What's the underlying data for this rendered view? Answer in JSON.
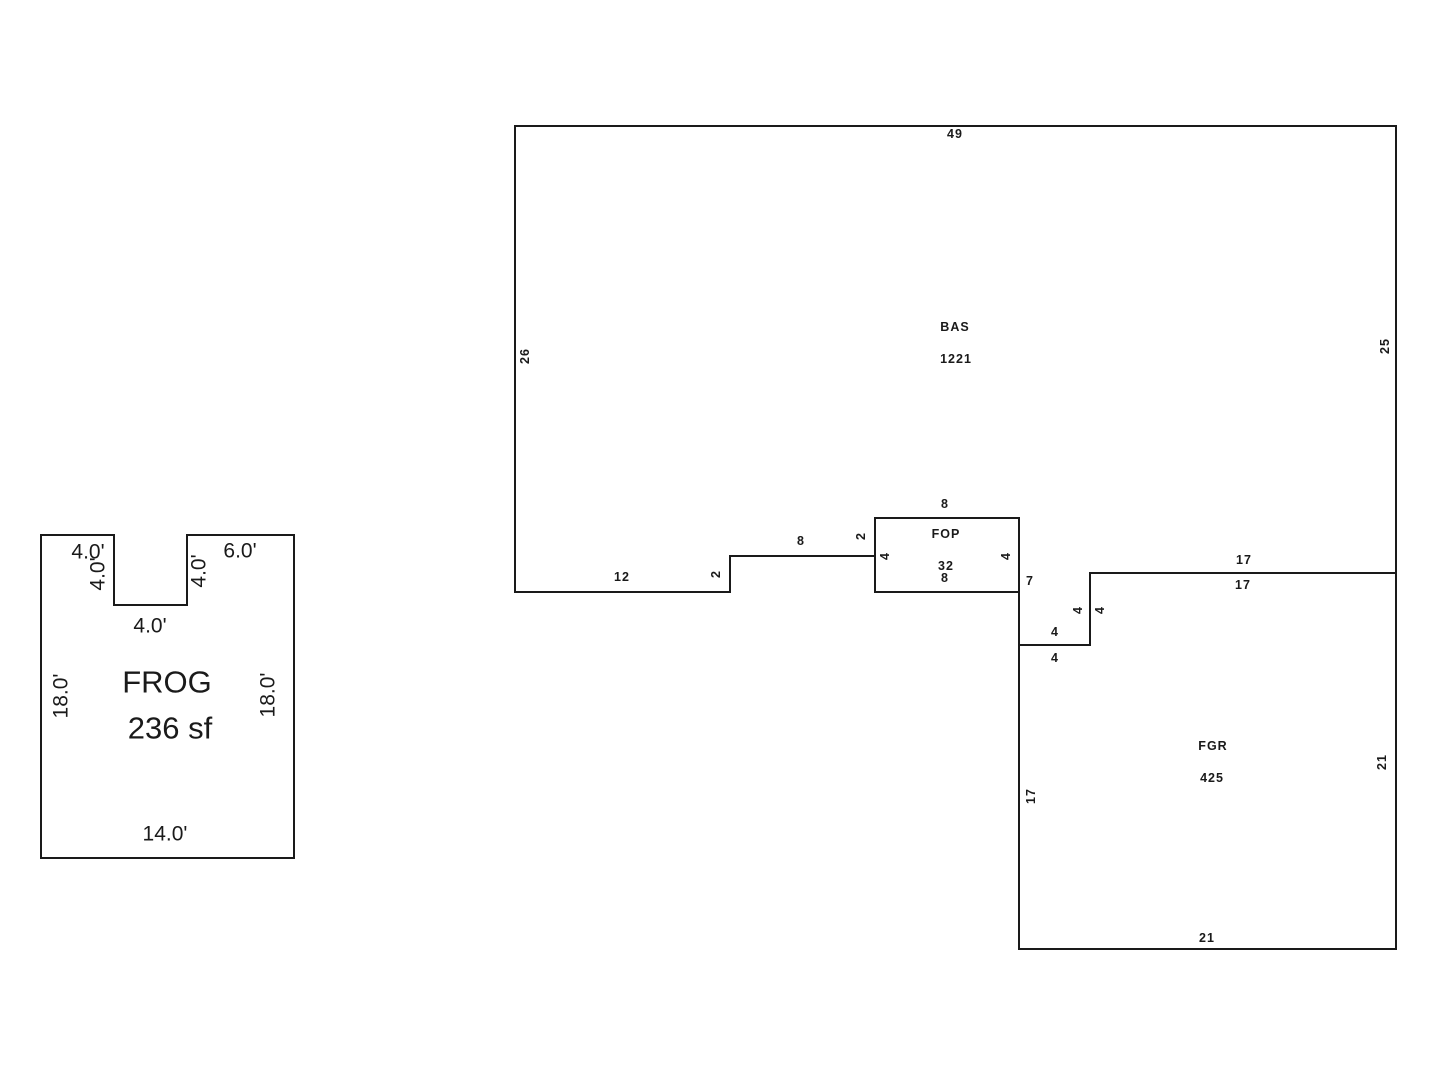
{
  "sketch": {
    "background_color": "#ffffff",
    "line_color": "#1a1a1a",
    "bas": {
      "name": "BAS",
      "area": "1221",
      "dim_top": "49",
      "dim_left": "26",
      "dim_right": "25",
      "dim_bottom_right": "17",
      "dim_step_v": "4",
      "dim_step_h": "4",
      "dim_jog": "7",
      "dim_bottom_mid": "8",
      "dim_rise_right": "2",
      "dim_rise_left": "2",
      "dim_bottom_left": "12"
    },
    "fop": {
      "name": "FOP",
      "area": "32",
      "dim_top": "8",
      "dim_left": "4",
      "dim_right": "4",
      "dim_bottom": "8"
    },
    "fgr": {
      "name": "FGR",
      "area": "425",
      "dim_top": "17",
      "dim_right": "21",
      "dim_bottom": "21",
      "dim_left": "17",
      "dim_step_v": "4",
      "dim_step_h": "4"
    },
    "frog": {
      "name": "FROG",
      "area": "236 sf",
      "dim_top_left": "4.0'",
      "dim_notch_left": "4.0'",
      "dim_notch_bottom": "4.0'",
      "dim_notch_right": "4.0'",
      "dim_top_right": "6.0'",
      "dim_left": "18.0'",
      "dim_right": "18.0'",
      "dim_bottom": "14.0'"
    }
  }
}
